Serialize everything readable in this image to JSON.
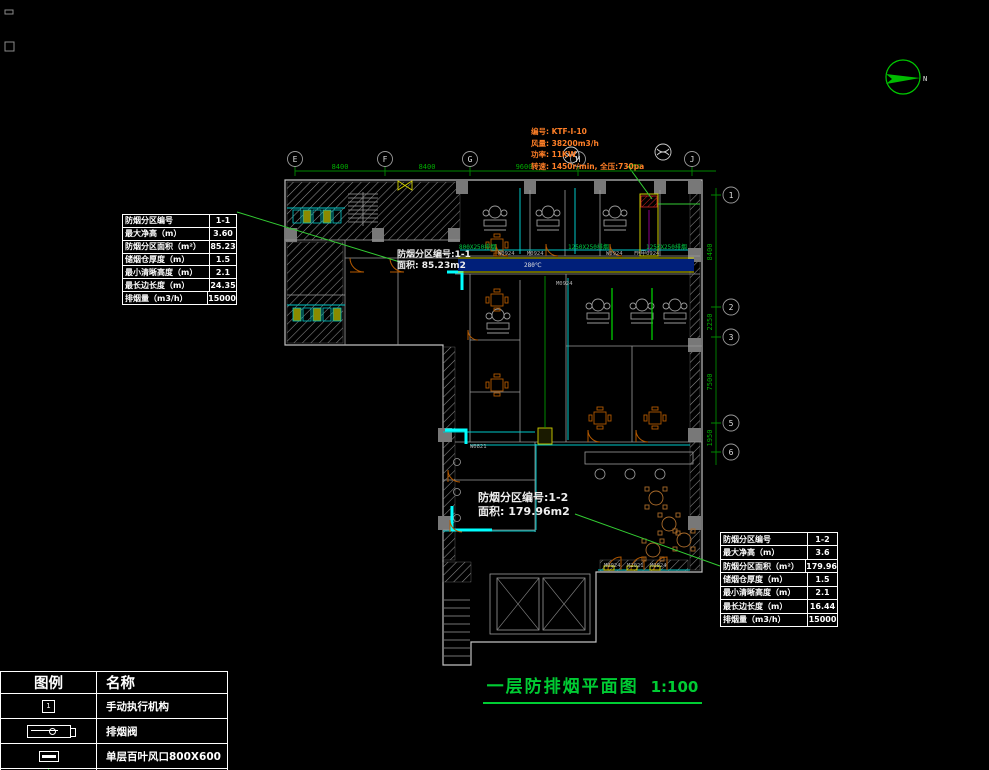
{
  "title_block": {
    "title": "一层防排烟平面图",
    "scale": "1:100"
  },
  "fan_spec": {
    "line1": "编号: KTF-I-10",
    "line2": "风量: 38200m3/h",
    "line3": "功率: 11KW",
    "line4": "转速: 1450r/min, 全压:730pa"
  },
  "zone1_label": {
    "line1": "防烟分区编号:1-1",
    "line2": "面积: 85.23m2"
  },
  "zone2_label": {
    "line1": "防烟分区编号:1-2",
    "line2": "面积: 179.96m2"
  },
  "spec_table_1": {
    "rows": [
      {
        "label": "防烟分区编号",
        "value": "1-1"
      },
      {
        "label": "最大净高（m）",
        "value": "3.60"
      },
      {
        "label": "防烟分区面积（m²）",
        "value": "85.23"
      },
      {
        "label": "储烟仓厚度（m）",
        "value": "1.5"
      },
      {
        "label": "最小清晰高度（m）",
        "value": "2.1"
      },
      {
        "label": "最长边长度（m）",
        "value": "24.35"
      },
      {
        "label": "排烟量（m3/h）",
        "value": "15000"
      }
    ]
  },
  "spec_table_2": {
    "rows": [
      {
        "label": "防烟分区编号",
        "value": "1-2"
      },
      {
        "label": "最大净高（m）",
        "value": "3.6"
      },
      {
        "label": "防烟分区面积（m²）",
        "value": "179.96"
      },
      {
        "label": "储烟仓厚度（m）",
        "value": "1.5"
      },
      {
        "label": "最小清晰高度（m）",
        "value": "2.1"
      },
      {
        "label": "最长边长度（m）",
        "value": "16.44"
      },
      {
        "label": "排烟量（m3/h）",
        "value": "15000"
      }
    ]
  },
  "legend": {
    "header_symbol": "图例",
    "header_name": "名称",
    "rows": [
      {
        "icon": "manual-actuator-icon",
        "icon_label": "1",
        "name": "手动执行机构"
      },
      {
        "icon": "smoke-exhaust-valve-icon",
        "name": "排烟阀"
      },
      {
        "icon": "louver-grille-icon",
        "name": "单层百叶风口800X600"
      },
      {
        "icon": "fire-damper-icon",
        "name": "280℃防火阀"
      }
    ]
  },
  "grid": {
    "top_bubbles": [
      "E",
      "F",
      "G",
      "H",
      "J"
    ],
    "top_dims": [
      "8400",
      "8400",
      "9600",
      "750"
    ],
    "right_bubbles": [
      "1",
      "2",
      "3",
      "5",
      "6"
    ],
    "right_dims": [
      "8400",
      "2250",
      "7500",
      "1950"
    ]
  },
  "plan_labels": {
    "duct_1": "800X250排烟",
    "duct_2": "1250X250排烟",
    "duct_3": "1250X250排烟",
    "damper_temp": "280℃",
    "wall_1": "W0924",
    "wall_2": "M0924",
    "wall_3": "W0924",
    "wall_4": "FM甲0924",
    "wall_5": "M0924",
    "wall_6": "W0821",
    "door_1": "M0924",
    "door_2": "M2021",
    "door_3": "M0924"
  },
  "north_label": "N",
  "colors": {
    "annotation_green": "#00bf00",
    "duct_cyan": "#00c8c8",
    "highlight_yellow": "#d8d800",
    "fan_spec_orange": "#ff7f27",
    "door_orange": "#b35900",
    "title_green": "#00cc33"
  }
}
